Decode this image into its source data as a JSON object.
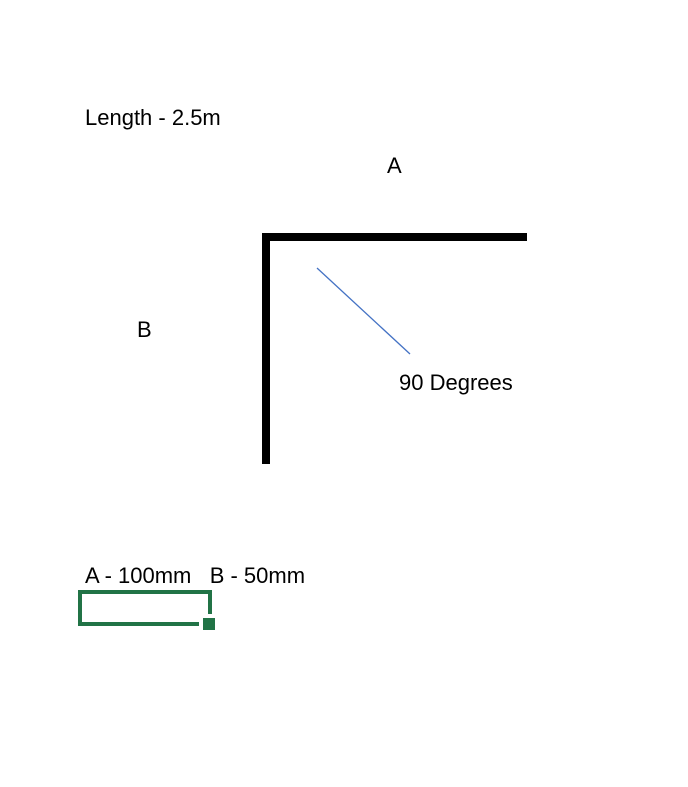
{
  "diagram": {
    "length_note": "Length - 2.5m",
    "side_a_label": "A",
    "side_b_label": "B",
    "angle_label": "90 Degrees",
    "dimensions_note": "A - 100mm   B - 50mm"
  },
  "colors": {
    "background": "#ffffff",
    "text": "#000000",
    "shape_line": "#000000",
    "angle_line": "#4472c4",
    "selection_green": "#217346"
  }
}
